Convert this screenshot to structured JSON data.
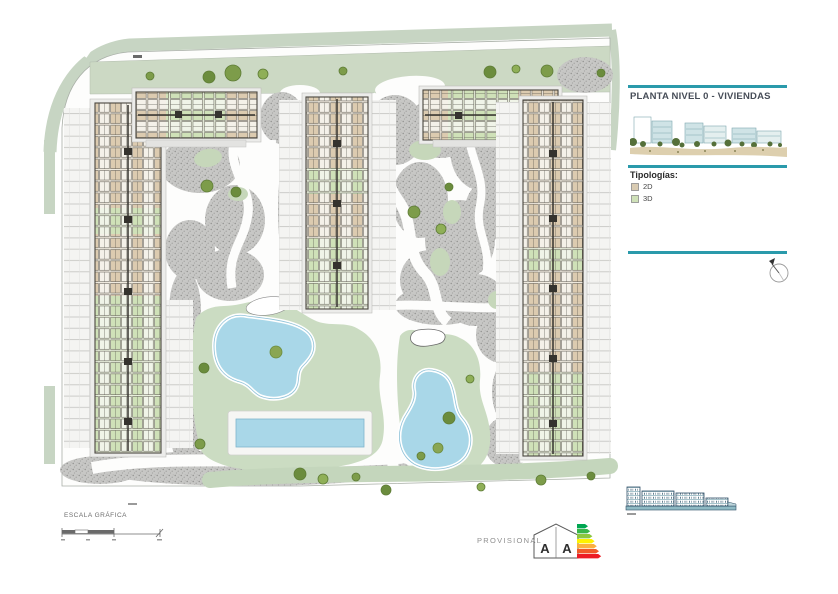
{
  "sheet": {
    "title": "PLANTA NIVEL 0 - VIVIENDAS",
    "legend": {
      "heading": "Tipologías:",
      "items": [
        {
          "label": "2D",
          "color": "#d9cbb2"
        },
        {
          "label": "3D",
          "color": "#cfe1b8"
        }
      ]
    },
    "footer": {
      "scale_label": "ESCALA GRÁFICA",
      "provisional": "PROVISIONAL"
    },
    "energy_letters": [
      "A",
      "A"
    ],
    "colors": {
      "accent_teal": "#2a9aab",
      "pool_blue": "#a9d7e8",
      "lawn_green": "#cbdcc2",
      "hardscape_gray": "#c7c7c5",
      "perimeter_band": "#c7d5c3",
      "unit_2d": "#dccbb0",
      "unit_3d": "#cfe1b8",
      "energy_arrows": [
        "#00a651",
        "#39b54a",
        "#8dc63f",
        "#fff200",
        "#fbb040",
        "#f15a29",
        "#ed1c24"
      ]
    }
  }
}
